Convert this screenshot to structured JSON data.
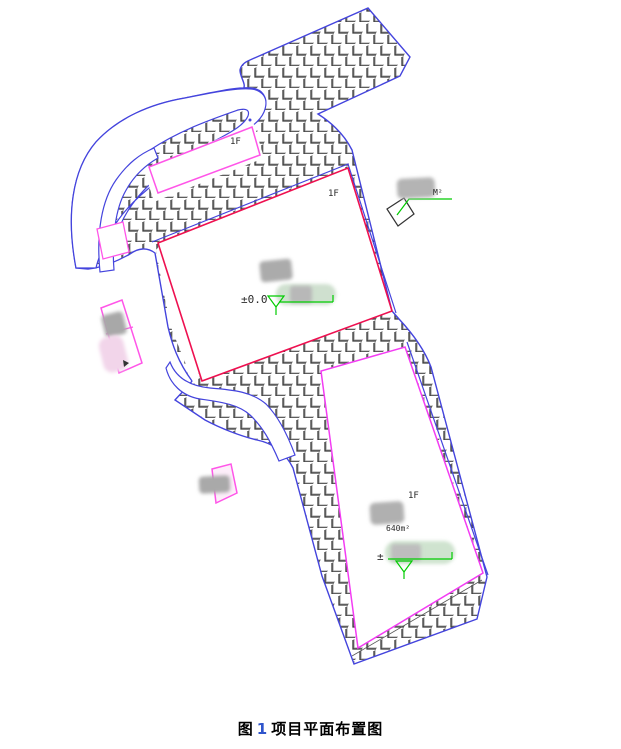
{
  "figure": {
    "caption": {
      "prefix": "图",
      "number": "1",
      "title": "项目平面布置图"
    }
  },
  "plan": {
    "labels": {
      "north_parcel_floor": "1F",
      "upper_building_floor": "1F",
      "lower_building_floor": "1F",
      "upper_building_elevation": "±0.0",
      "lower_building_area": "640m²",
      "lower_building_elevation": "±",
      "annotation_area_unit": "M²"
    },
    "colors": {
      "site_boundary_blue": "#4444dd",
      "upper_building_outline_red": "#ee1050",
      "lower_building_outline_magenta": "#f33cf3",
      "annotation_magenta": "#ff55e8",
      "survey_green": "#00cc00",
      "hatch_stroke_gray": "#3a3a3a"
    },
    "icons": [
      "elevation-marker-icon",
      "leader-line-icon",
      "survey-square-icon"
    ]
  }
}
